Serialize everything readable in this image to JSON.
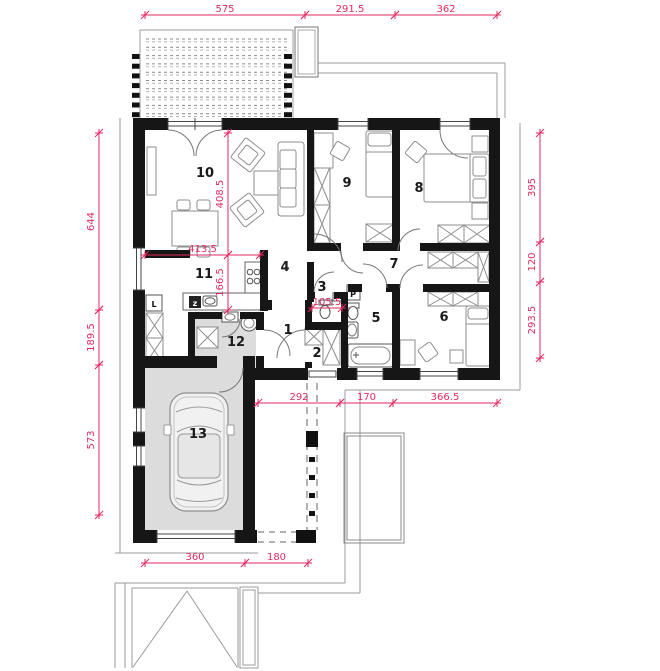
{
  "title": "Single-storey house floor plan with garage",
  "colors": {
    "dimension": "#e22a5f",
    "wall": "#161616",
    "floor_gray": "#dcdcdc",
    "furniture_line": "#8e8e8e",
    "outline_gray": "#9b9b9b",
    "background": "#ffffff"
  },
  "rooms": [
    {
      "number": "1",
      "x": 288,
      "y": 334
    },
    {
      "number": "2",
      "x": 317,
      "y": 357
    },
    {
      "number": "3",
      "x": 322,
      "y": 291
    },
    {
      "number": "4",
      "x": 285,
      "y": 271
    },
    {
      "number": "5",
      "x": 376,
      "y": 322
    },
    {
      "number": "6",
      "x": 444,
      "y": 321
    },
    {
      "number": "7",
      "x": 394,
      "y": 268
    },
    {
      "number": "8",
      "x": 419,
      "y": 192
    },
    {
      "number": "9",
      "x": 347,
      "y": 187
    },
    {
      "number": "10",
      "x": 205,
      "y": 177
    },
    {
      "number": "11",
      "x": 204,
      "y": 278
    },
    {
      "number": "12",
      "x": 236,
      "y": 346
    },
    {
      "number": "13",
      "x": 198,
      "y": 438
    }
  ],
  "fixture_labels": [
    {
      "text": "L",
      "x": 154,
      "y": 307
    },
    {
      "text": "z",
      "x": 195,
      "y": 306
    },
    {
      "text": "P",
      "x": 353,
      "y": 297
    }
  ],
  "dimensions": [
    {
      "value": "575",
      "orient": "h",
      "x1": 145,
      "x2": 305,
      "y": 15
    },
    {
      "value": "291.5",
      "orient": "h",
      "x1": 305,
      "x2": 395,
      "y": 15
    },
    {
      "value": "362",
      "orient": "h",
      "x1": 395,
      "x2": 497,
      "y": 15
    },
    {
      "value": "644",
      "orient": "v",
      "y1": 133,
      "y2": 310,
      "x": 99
    },
    {
      "value": "189.5",
      "orient": "v",
      "y1": 310,
      "y2": 365,
      "x": 99
    },
    {
      "value": "573",
      "orient": "v",
      "y1": 365,
      "y2": 515,
      "x": 99
    },
    {
      "value": "395",
      "orient": "v",
      "y1": 133,
      "y2": 242,
      "x": 540
    },
    {
      "value": "120",
      "orient": "v",
      "y1": 242,
      "y2": 282,
      "x": 540
    },
    {
      "value": "293.5",
      "orient": "v",
      "y1": 282,
      "y2": 358,
      "x": 540
    },
    {
      "value": "408.5",
      "orient": "v",
      "y1": 133,
      "y2": 255,
      "x": 228
    },
    {
      "value": "166.5",
      "orient": "v",
      "y1": 255,
      "y2": 310,
      "x": 228
    },
    {
      "value": "413.5",
      "orient": "h",
      "x1": 145,
      "x2": 260,
      "y": 255
    },
    {
      "value": "105.5",
      "orient": "h",
      "x1": 312,
      "x2": 342,
      "y": 308
    },
    {
      "value": "292",
      "orient": "h",
      "x1": 258,
      "x2": 340,
      "y": 403
    },
    {
      "value": "170",
      "orient": "h",
      "x1": 340,
      "x2": 393,
      "y": 403
    },
    {
      "value": "366.5",
      "orient": "h",
      "x1": 393,
      "x2": 497,
      "y": 403
    },
    {
      "value": "360",
      "orient": "h",
      "x1": 145,
      "x2": 245,
      "y": 563
    },
    {
      "value": "180",
      "orient": "h",
      "x1": 245,
      "x2": 308,
      "y": 563
    }
  ]
}
